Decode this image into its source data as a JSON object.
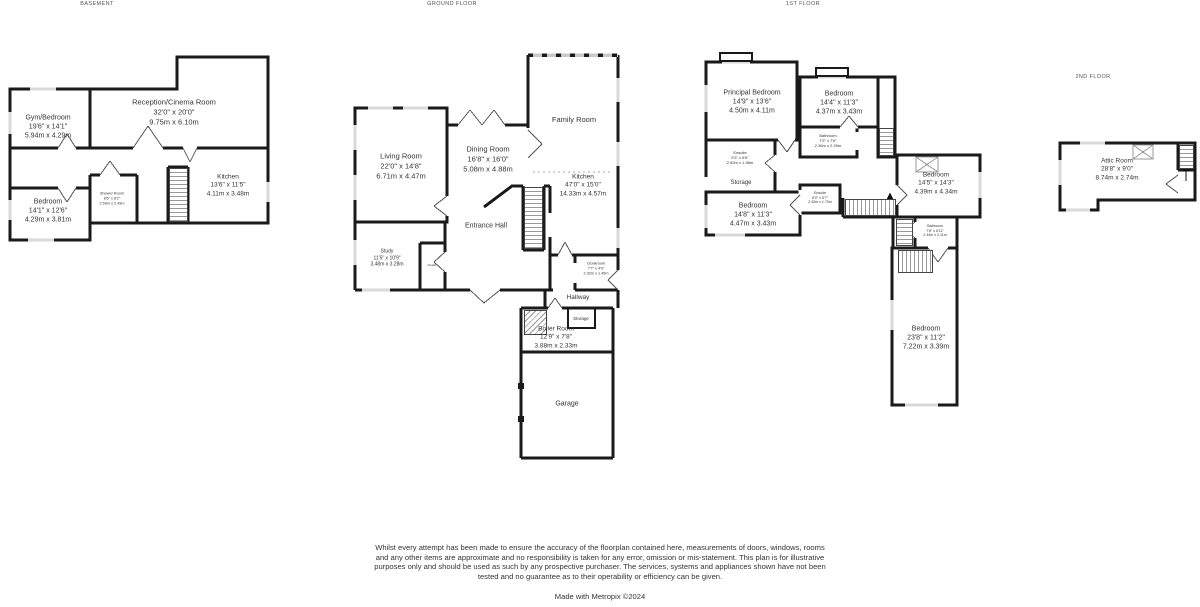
{
  "page": {
    "background": "#ffffff",
    "wall_color": "#1a1a1a",
    "window_color": "#d9d9d9"
  },
  "floors": [
    {
      "title": "BASEMENT",
      "rooms": [
        {
          "name": "Gym/Bedroom",
          "imperial": "19'6\" x 14'1\"",
          "metric": "5.94m x 4.29m"
        },
        {
          "name": "Reception/Cinema Room",
          "imperial": "32'0\" x 20'0\"",
          "metric": "9.75m x 6.10m"
        },
        {
          "name": "Kitchen",
          "imperial": "13'6\" x 11'5\"",
          "metric": "4.11m x 3.48m"
        },
        {
          "name": "Bedroom",
          "imperial": "14'1\" x 12'6\"",
          "metric": "4.29m x 3.81m"
        },
        {
          "name": "Shower Room",
          "imperial": "8'6\" x 8'2\"",
          "metric": "2.59m x 2.49m"
        }
      ]
    },
    {
      "title": "GROUND FLOOR",
      "rooms": [
        {
          "name": "Living Room",
          "imperial": "22'0\" x 14'8\"",
          "metric": "6.71m x 4.47m"
        },
        {
          "name": "Dining Room",
          "imperial": "16'8\" x 16'0\"",
          "metric": "5.08m x 4.88m"
        },
        {
          "name": "Family Room"
        },
        {
          "name": "Kitchen",
          "imperial": "47'0\" x 15'0\"",
          "metric": "14.33m x 4.57m"
        },
        {
          "name": "Entrance Hall"
        },
        {
          "name": "Study",
          "imperial": "11'5\" x 10'9\"",
          "metric": "3.48m x 3.28m"
        },
        {
          "name": "Cloaks"
        },
        {
          "name": "Cloakroom",
          "imperial": "7'7\" x 4'9\"",
          "metric": "2.32m x 1.45m"
        },
        {
          "name": "Hallway"
        },
        {
          "name": "Storage"
        },
        {
          "name": "Boiler Room",
          "imperial": "12'9\" x 7'8\"",
          "metric": "3.88m x 2.33m"
        },
        {
          "name": "Garage"
        }
      ]
    },
    {
      "title": "1ST FLOOR",
      "rooms": [
        {
          "name": "Principal Bedroom",
          "imperial": "14'9\" x 13'6\"",
          "metric": "4.50m x 4.11m"
        },
        {
          "name": "Bedroom",
          "imperial": "14'4\" x 11'3\"",
          "metric": "4.37m x 3.43m"
        },
        {
          "name": "Bathroom",
          "imperial": "7'9\" x 7'6\"",
          "metric": "2.36m x 2.29m"
        },
        {
          "name": "Ensuite",
          "imperial": "9'3\" x 6'6\"",
          "metric": "2.82m x 1.98m"
        },
        {
          "name": "Storage"
        },
        {
          "name": "Bedroom",
          "imperial": "14'8\" x 11'3\"",
          "metric": "4.47m x 3.43m"
        },
        {
          "name": "Ensuite",
          "imperial": "8'0\" x 5'7\"",
          "metric": "2.43m x 1.70m"
        },
        {
          "name": "Bedroom",
          "imperial": "14'5\" x 14'3\"",
          "metric": "4.39m x 4.34m"
        },
        {
          "name": "Bathroom",
          "imperial": "7'8\" x 6'11\"",
          "metric": "2.34m x 2.11m"
        },
        {
          "name": "Bedroom",
          "imperial": "23'8\" x 11'2\"",
          "metric": "7.22m x 3.39m"
        }
      ]
    },
    {
      "title": "2ND FLOOR",
      "rooms": [
        {
          "name": "Attic Room",
          "imperial": "28'8\" x 9'0\"",
          "metric": "8.74m x 2.74m"
        }
      ]
    }
  ],
  "footer": {
    "disclaimer": "Whilst every attempt has been made to ensure the accuracy of the floorplan contained here, measurements of doors, windows, rooms and any other items are approximate and no responsibility is taken for any error, omission or mis-statement. This plan is for illustrative purposes only and should be used as such by any prospective purchaser. The services, systems and appliances shown have not been tested and no guarantee as to their operability or efficiency can be given.",
    "credit": "Made with Metropix ©2024"
  }
}
